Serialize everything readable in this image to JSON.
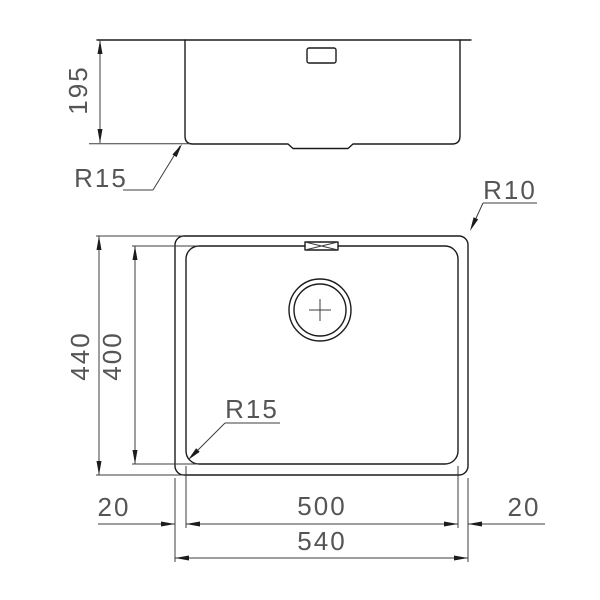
{
  "drawing": {
    "title": "sink-dimension-drawing",
    "side_view": {
      "height_label": "195",
      "corner_radius_label": "R15"
    },
    "plan_view": {
      "outer_height_label": "440",
      "inner_height_label": "400",
      "inner_width_label": "500",
      "outer_width_label": "540",
      "left_margin_label": "20",
      "right_margin_label": "20",
      "outer_corner_radius_label": "R10",
      "inner_corner_radius_label": "R15"
    },
    "colors": {
      "line": "#1c1c1c",
      "dimension_line": "#3d3d3d",
      "dimension_text": "#555555",
      "background": "#ffffff"
    }
  }
}
